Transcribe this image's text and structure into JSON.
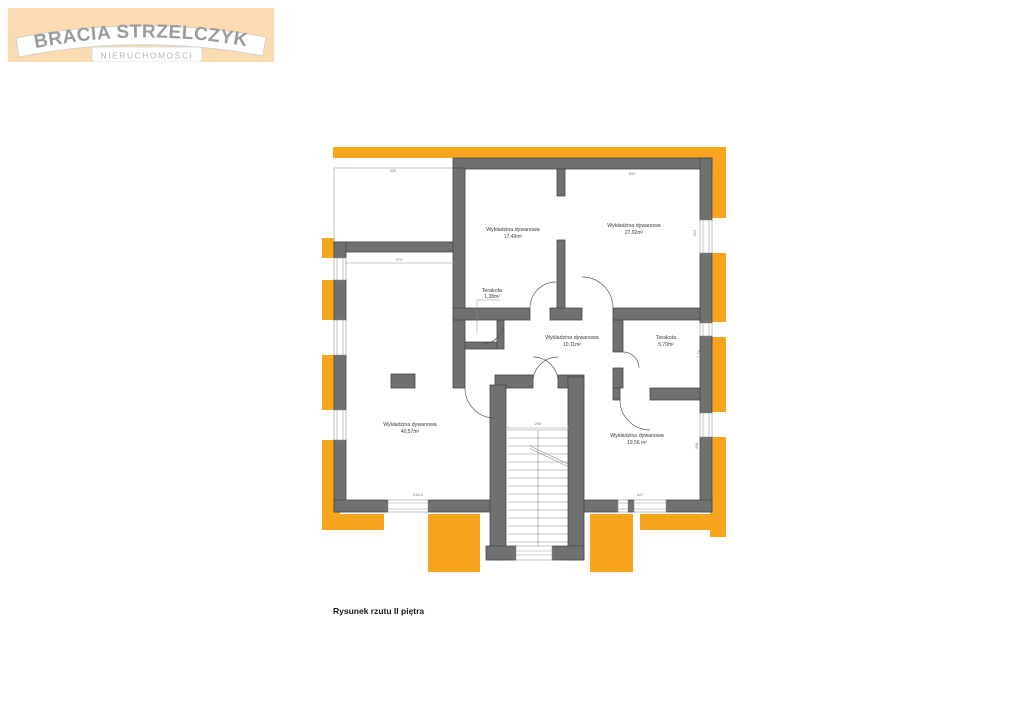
{
  "logo": {
    "line1": "BRACIA STRZELCZYK",
    "line2": "NIERUCHOMOŚCI"
  },
  "caption": "Rysunek rzutu II piętra",
  "floor_plan": {
    "rooms": [
      {
        "name": "Wykładzina dywanowa",
        "area": "17,49m²"
      },
      {
        "name": "Wykładzina dywanowa",
        "area": "27,92m²"
      },
      {
        "name": "Terakota",
        "area": "1,38m²"
      },
      {
        "name": "Wykładzina dywanowa",
        "area": "10,11m²"
      },
      {
        "name": "Terakota",
        "area": "5,70m²"
      },
      {
        "name": "Wykładzina dywanowa",
        "area": "40,57m²"
      },
      {
        "name": "Wykładzina dywanowa",
        "area": "19,56 m²"
      }
    ],
    "dimensions": {
      "terrace_width": "430",
      "top_right": "541",
      "left_wing": "370",
      "stairs_width": "298",
      "bottom_left": "518,5",
      "bottom_right": "447",
      "right_upper": "912",
      "right_middle": "1,74",
      "right_lower": "438"
    },
    "colors": {
      "accent_orange": "#F9A41D",
      "wall_gray": "#707070",
      "logo_background": "#FBDCB2"
    }
  }
}
